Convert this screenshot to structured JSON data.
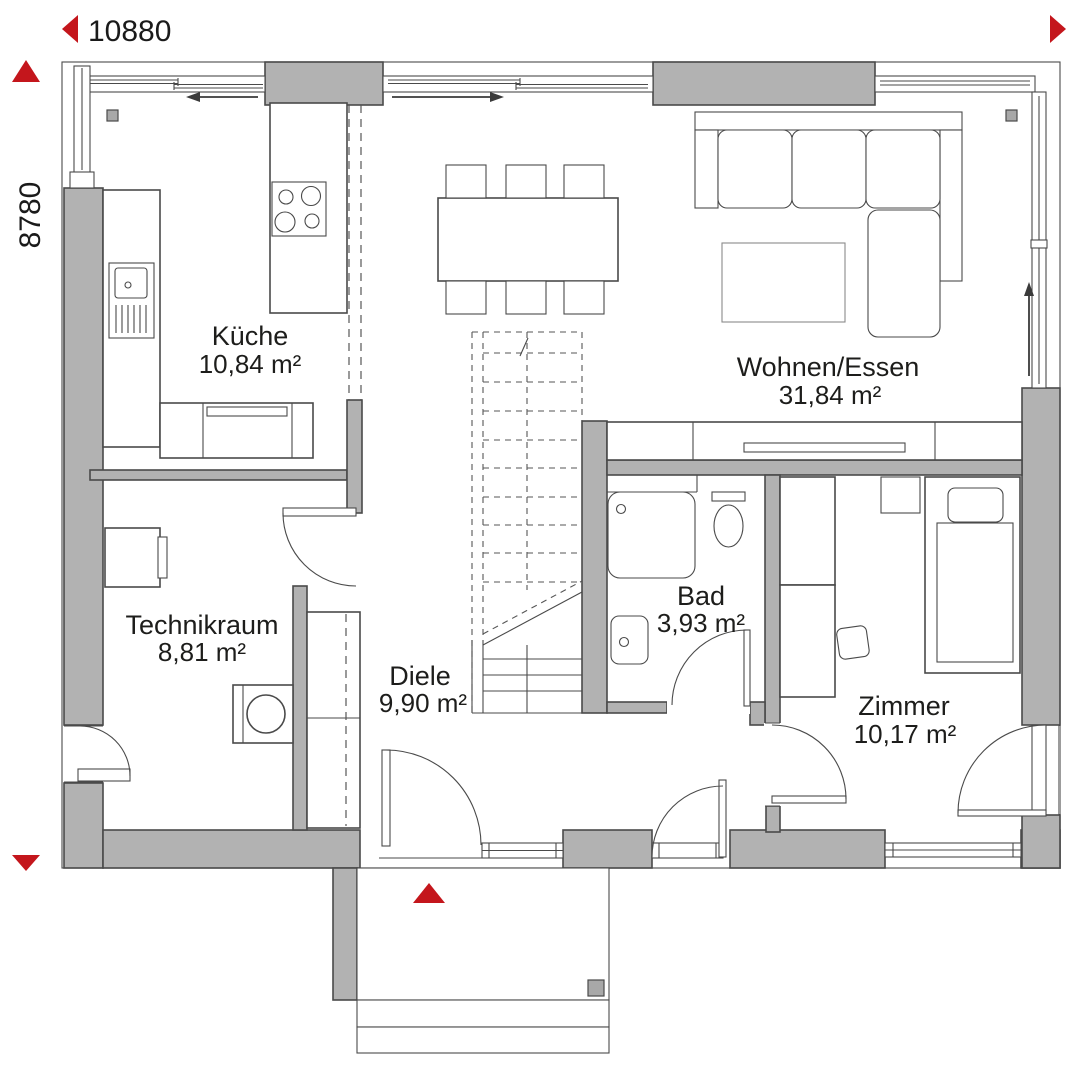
{
  "colors": {
    "wall": "#b2b2b2",
    "line": "#4a4a4a",
    "red": "#c4161c",
    "text": "#1d1d1b",
    "muted": "#8a8a8a"
  },
  "plan": {
    "dim_top": "10880",
    "dim_left": "8780",
    "rooms": [
      {
        "key": "kueche",
        "name": "Küche",
        "area": "10,84 m²"
      },
      {
        "key": "wohnen",
        "name": "Wohnen/Essen",
        "area": "31,84 m²"
      },
      {
        "key": "technikraum",
        "name": "Technikraum",
        "area": "8,81 m²"
      },
      {
        "key": "diele",
        "name": "Diele",
        "area": "9,90 m²"
      },
      {
        "key": "bad",
        "name": "Bad",
        "area": "3,93 m²"
      },
      {
        "key": "zimmer",
        "name": "Zimmer",
        "area": "10,17 m²"
      }
    ]
  },
  "symbols": {
    "dim_arrow_left": "triangle-left",
    "dim_arrow_right": "triangle-right",
    "dim_arrow_up": "triangle-up",
    "dim_arrow_down": "triangle-down",
    "entrance_marker": "triangle-up",
    "window_slide_arrows": "thin-arrow"
  }
}
